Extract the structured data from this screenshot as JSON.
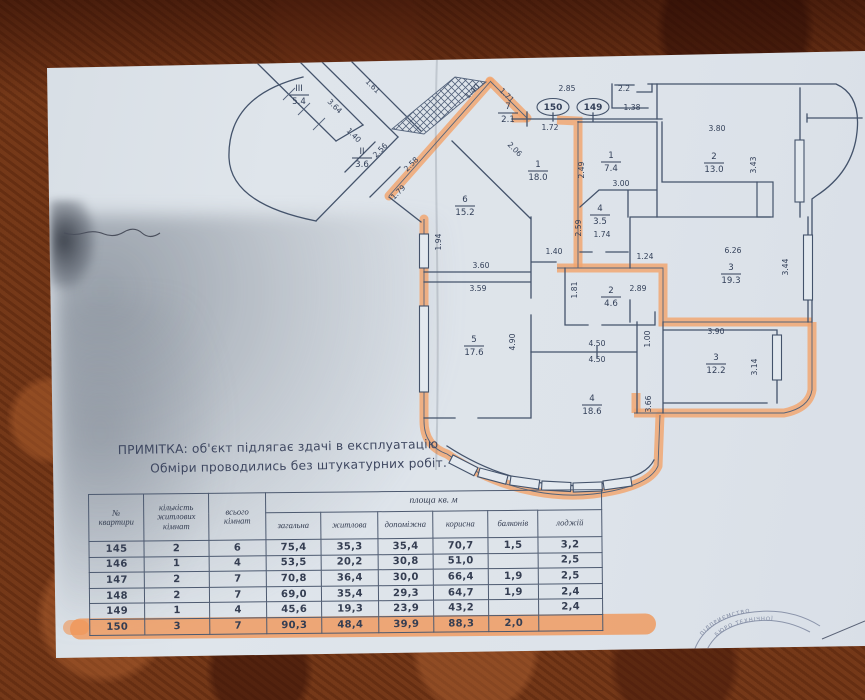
{
  "note": {
    "line1": "ПРИМІТКА: об'єкт підлягає здачі в експлуатацію",
    "line2": "Обміри проводились без штукатурних робіт."
  },
  "table": {
    "col_apartment": "№\nквартири",
    "col_living_rooms": "кількість\nжитлових\nкімнат",
    "col_total_rooms": "всього\nкімнат",
    "area_group": "площа кв. м",
    "area_cols": [
      "загальна",
      "житлова",
      "допоміжна",
      "корисна",
      "балконів",
      "лоджій"
    ],
    "rows": [
      {
        "cells": [
          "145",
          "2",
          "6",
          "75,4",
          "35,3",
          "35,4",
          "70,7",
          "1,5",
          "3,2"
        ],
        "highlight": false
      },
      {
        "cells": [
          "146",
          "1",
          "4",
          "53,5",
          "20,2",
          "30,8",
          "51,0",
          "",
          "2,5"
        ],
        "highlight": false
      },
      {
        "cells": [
          "147",
          "2",
          "7",
          "70,8",
          "36,4",
          "30,0",
          "66,4",
          "1,9",
          "2,5"
        ],
        "highlight": false
      },
      {
        "cells": [
          "148",
          "2",
          "7",
          "69,0",
          "35,4",
          "29,3",
          "64,7",
          "1,9",
          "2,4"
        ],
        "highlight": false
      },
      {
        "cells": [
          "149",
          "1",
          "4",
          "45,6",
          "19,3",
          "23,9",
          "43,2",
          "",
          "2,4"
        ],
        "highlight": false
      },
      {
        "cells": [
          "150",
          "3",
          "7",
          "90,3",
          "48,4",
          "39,9",
          "88,3",
          "2,0",
          ""
        ],
        "highlight": true
      }
    ]
  },
  "plan": {
    "unit_labels": [
      {
        "t": "150",
        "x": 553,
        "y": 107
      },
      {
        "t": "149",
        "x": 593,
        "y": 107
      }
    ],
    "room_labels": [
      {
        "n": "III",
        "a": "5.4",
        "x": 299,
        "y": 94
      },
      {
        "n": "II",
        "a": "3.6",
        "x": 362,
        "y": 157
      },
      {
        "n": "7",
        "a": "2.1",
        "x": 508,
        "y": 112
      },
      {
        "n": "1",
        "a": "18.0",
        "x": 538,
        "y": 170
      },
      {
        "n": "6",
        "a": "15.2",
        "x": 465,
        "y": 205
      },
      {
        "n": "1",
        "a": "7.4",
        "x": 611,
        "y": 161
      },
      {
        "n": "2",
        "a": "13.0",
        "x": 714,
        "y": 162
      },
      {
        "n": "4",
        "a": "3.5",
        "x": 600,
        "y": 214
      },
      {
        "n": "3",
        "a": "19.3",
        "x": 731,
        "y": 273
      },
      {
        "n": "2",
        "a": "4.6",
        "x": 611,
        "y": 296
      },
      {
        "n": "5",
        "a": "17.6",
        "x": 474,
        "y": 345
      },
      {
        "n": "3",
        "a": "12.2",
        "x": 716,
        "y": 363
      },
      {
        "n": "4",
        "a": "18.6",
        "x": 592,
        "y": 404
      }
    ],
    "dim_labels": [
      {
        "t": "3.64",
        "x": 333,
        "y": 108,
        "r": 45
      },
      {
        "t": "1.61",
        "x": 371,
        "y": 88,
        "r": 45
      },
      {
        "t": "1.40",
        "x": 352,
        "y": 137,
        "r": 45
      },
      {
        "t": "2.56",
        "x": 382,
        "y": 152,
        "r": -45
      },
      {
        "t": "1.40",
        "x": 474,
        "y": 93,
        "r": -45
      },
      {
        "t": "1.71",
        "x": 505,
        "y": 97,
        "r": 45
      },
      {
        "t": "2.06",
        "x": 513,
        "y": 151,
        "r": 45
      },
      {
        "t": "2.58",
        "x": 413,
        "y": 166,
        "r": -45
      },
      {
        "t": "1.79",
        "x": 400,
        "y": 194,
        "r": -45
      },
      {
        "t": "1.94",
        "x": 441,
        "y": 242,
        "r": -90
      },
      {
        "t": "2.85",
        "x": 567,
        "y": 91,
        "r": 0
      },
      {
        "t": "1.72",
        "x": 550,
        "y": 130,
        "r": 0
      },
      {
        "t": "2.49",
        "x": 584,
        "y": 170,
        "r": -90
      },
      {
        "t": "2.2",
        "x": 624,
        "y": 91,
        "r": 0
      },
      {
        "t": "1.38",
        "x": 632,
        "y": 110,
        "r": 0
      },
      {
        "t": "3.00",
        "x": 621,
        "y": 186,
        "r": 0
      },
      {
        "t": "3.80",
        "x": 717,
        "y": 131,
        "r": 0
      },
      {
        "t": "3.43",
        "x": 756,
        "y": 165,
        "r": -90
      },
      {
        "t": "2.59",
        "x": 581,
        "y": 228,
        "r": -90
      },
      {
        "t": "1.74",
        "x": 602,
        "y": 237,
        "r": 0
      },
      {
        "t": "1.24",
        "x": 645,
        "y": 259,
        "r": 0
      },
      {
        "t": "6.26",
        "x": 733,
        "y": 253,
        "r": 0
      },
      {
        "t": "3.44",
        "x": 788,
        "y": 267,
        "r": -90
      },
      {
        "t": "1.81",
        "x": 577,
        "y": 290,
        "r": -90
      },
      {
        "t": "2.89",
        "x": 638,
        "y": 291,
        "r": 0
      },
      {
        "t": "1.40",
        "x": 554,
        "y": 254,
        "r": 0
      },
      {
        "t": "3.60",
        "x": 481,
        "y": 268,
        "r": 0
      },
      {
        "t": "3.59",
        "x": 478,
        "y": 291,
        "r": 0
      },
      {
        "t": "4.90",
        "x": 515,
        "y": 342,
        "r": -90
      },
      {
        "t": "1.00",
        "x": 650,
        "y": 339,
        "r": -90
      },
      {
        "t": "4.50",
        "x": 597,
        "y": 346,
        "r": 0
      },
      {
        "t": "4.50",
        "x": 597,
        "y": 362,
        "r": 0
      },
      {
        "t": "3.90",
        "x": 716,
        "y": 334,
        "r": 0
      },
      {
        "t": "3.14",
        "x": 757,
        "y": 367,
        "r": -90
      },
      {
        "t": "3.66",
        "x": 651,
        "y": 404,
        "r": -90
      }
    ],
    "stamp": {
      "line1": "ПІДПРИЄМСТВО",
      "line2": "БЮРО ТЕХНІЧНОЇ"
    }
  },
  "colors": {
    "highlight": "#f1a56e",
    "paper": "#dde3ea",
    "table_surface": "#6e3214",
    "line": "#44536b"
  }
}
